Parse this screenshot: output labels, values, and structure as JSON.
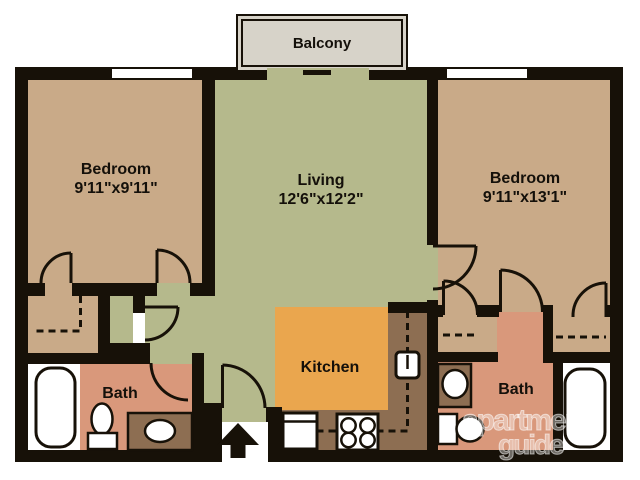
{
  "rooms": {
    "bedroom_left": {
      "name": "Bedroom",
      "dims": "9'11\"x9'11\""
    },
    "living": {
      "name": "Living",
      "dims": "12'6\"x12'2\""
    },
    "bedroom_right": {
      "name": "Bedroom",
      "dims": "9'11\"x13'1\""
    },
    "kitchen": {
      "name": "Kitchen"
    },
    "bath_left": {
      "name": "Bath"
    },
    "bath_right": {
      "name": "Bath"
    },
    "balcony": {
      "name": "Balcony"
    }
  },
  "watermark": {
    "line1": "apartment",
    "line2": "guide"
  },
  "colors": {
    "wall": "#171108",
    "bedroom_tan": "#c9aa88",
    "living_olive": "#b5b98c",
    "kitchen_orange": "#eaa64e",
    "counter_brown": "#8d6e52",
    "bath_salmon": "#d9987b",
    "balcony_gray": "#d7d3c9"
  }
}
